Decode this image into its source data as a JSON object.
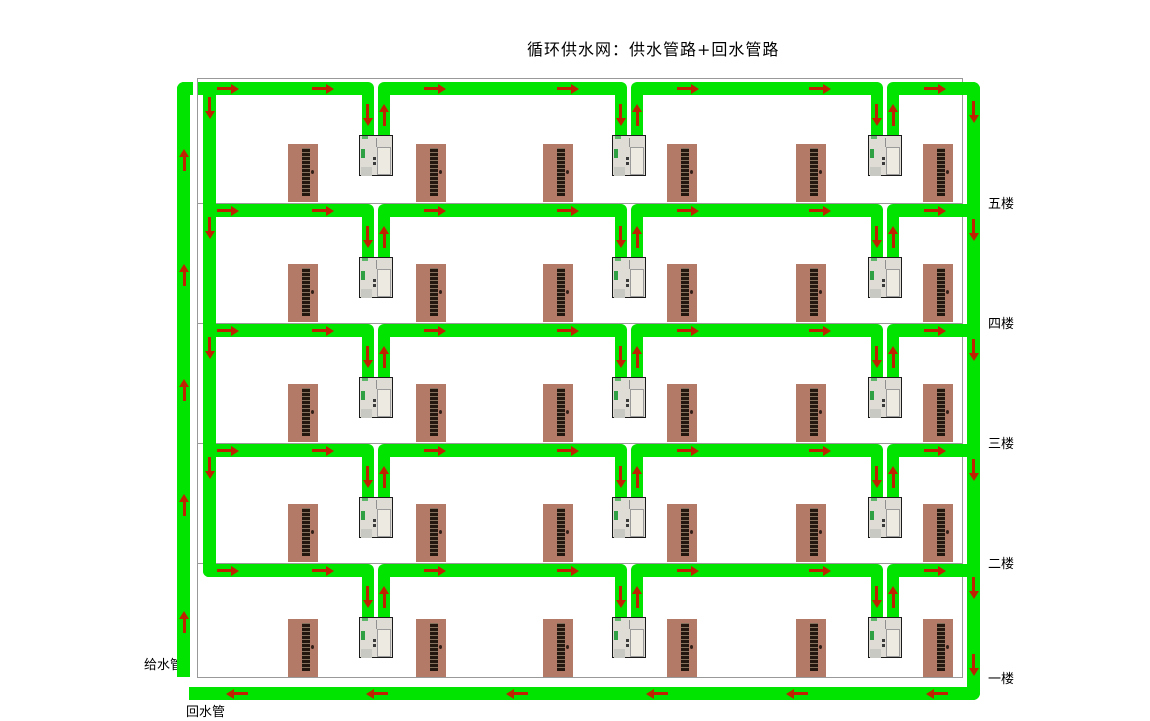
{
  "title": "循环供水网：供水管路+回水管路",
  "labels": {
    "supply_pipe": "给水管",
    "return_pipe": "回水管"
  },
  "colors": {
    "pipe_green": "#00e400",
    "arrow_red": "#bf2200",
    "door_brown": "#b47a68",
    "door_sign_dark": "#231710",
    "outline_gray": "#999999",
    "background": "#ffffff"
  },
  "floors": [
    {
      "label": "五楼",
      "pipe_y": 82,
      "slab_y": 203
    },
    {
      "label": "四楼",
      "pipe_y": 204,
      "slab_y": 323
    },
    {
      "label": "三楼",
      "pipe_y": 324,
      "slab_y": 443
    },
    {
      "label": "二楼",
      "pipe_y": 444,
      "slab_y": 563
    },
    {
      "label": "一楼",
      "pipe_y": 564,
      "slab_y": 678
    }
  ],
  "layout": {
    "building": {
      "left": 197,
      "top": 78,
      "right": 963,
      "bottom": 678
    },
    "pipe_thickness": 13,
    "dispenser_centers_x": [
      376,
      629,
      885
    ],
    "door_centers_x": [
      303,
      431,
      558,
      682,
      811,
      938
    ],
    "supply_riser": {
      "x": 177,
      "top": 82,
      "bottom": 677
    },
    "inner_drop_pipe": {
      "x": 203,
      "top": 82,
      "bottom": 577
    },
    "return_riser": {
      "x": 967,
      "top": 82,
      "bottom": 700
    },
    "return_pipe": {
      "y": 687,
      "left": 189,
      "right": 980
    },
    "arrows": {
      "floor_pipe_x": [
        228,
        323,
        435,
        568,
        688,
        820,
        935
      ],
      "return_pipe_x": [
        237,
        377,
        517,
        657,
        797,
        937
      ],
      "supply_riser_y": [
        160,
        275,
        390,
        505,
        622
      ],
      "inner_drop_y": [
        108,
        228,
        348,
        468
      ],
      "return_riser_y": [
        112,
        230,
        350,
        470,
        588,
        665
      ]
    },
    "title_pos": {
      "x": 527,
      "y": 36
    },
    "supply_label_pos": {
      "x": 144,
      "y": 654
    },
    "return_label_pos": {
      "x": 186,
      "y": 701
    },
    "floor_label_x": 988
  }
}
